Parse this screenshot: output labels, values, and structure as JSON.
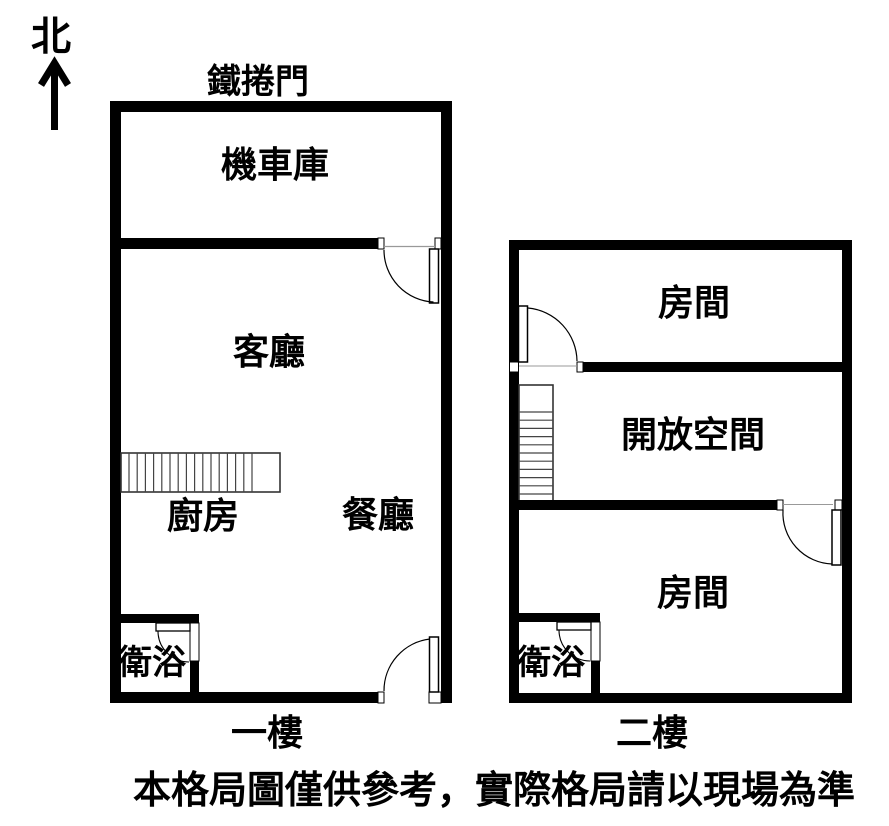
{
  "page": {
    "background_color": "#ffffff",
    "ink_color": "#000000",
    "type_label": "floor-plan"
  },
  "north": {
    "label": "北"
  },
  "floor1": {
    "name_label": "一樓",
    "exterior_label": "鐵捲門",
    "rooms": {
      "garage": "機車庫",
      "living": "客廳",
      "kitchen": "廚房",
      "dining": "餐廳",
      "bath": "衛浴"
    }
  },
  "floor2": {
    "name_label": "二樓",
    "rooms": {
      "room_top": "房間",
      "open_space": "開放空間",
      "room_bottom": "房間",
      "bath": "衛浴"
    }
  },
  "disclaimer": "本格局圖僅供參考，實際格局請以現場為準"
}
